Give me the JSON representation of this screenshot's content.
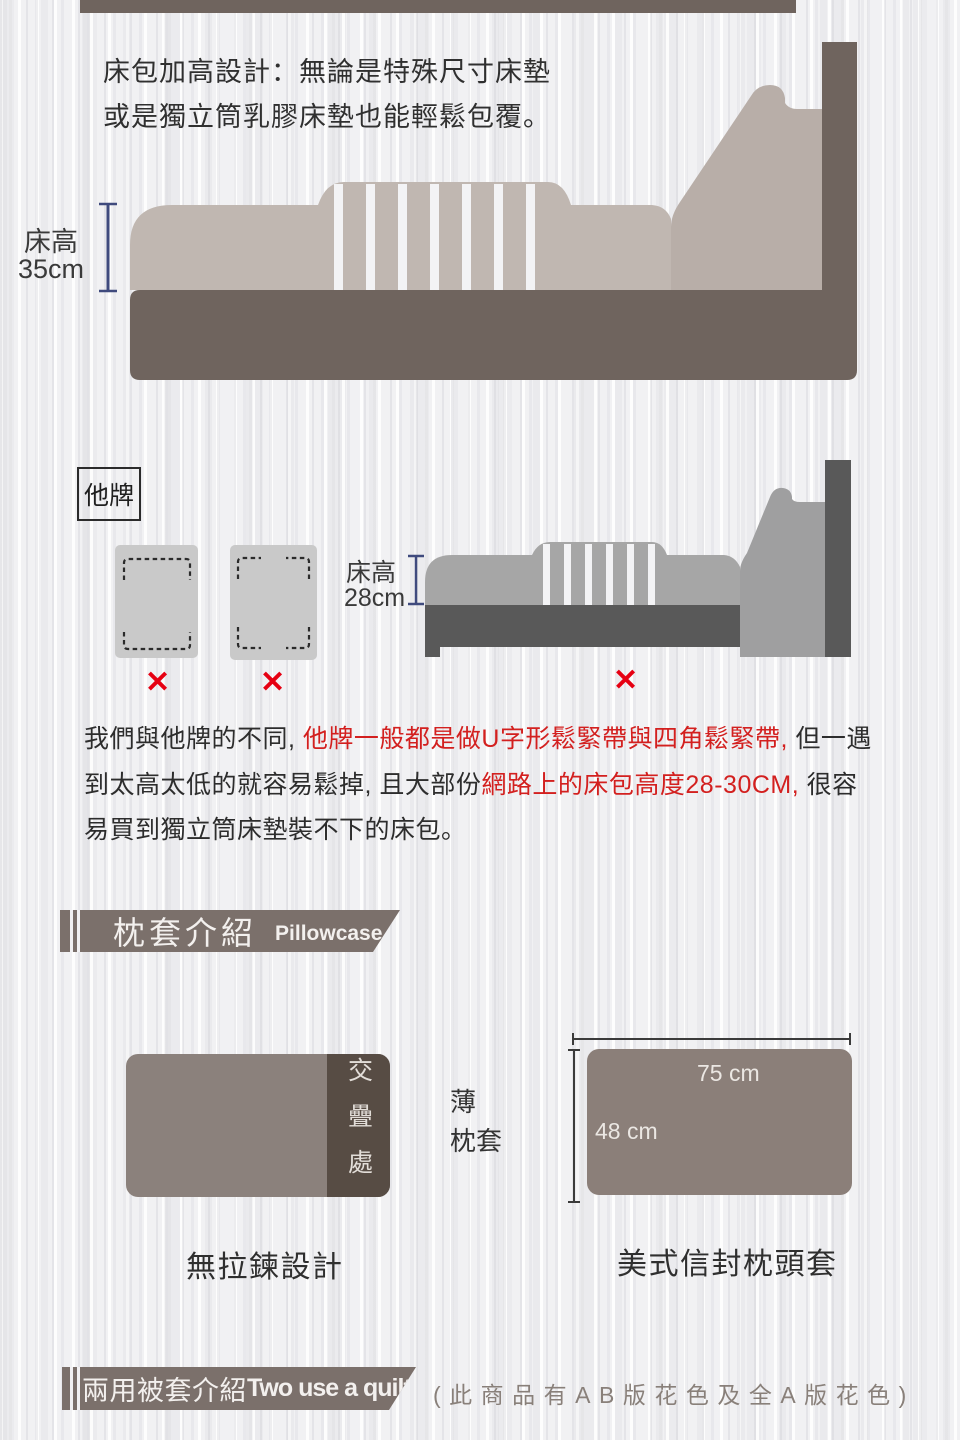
{
  "intro": {
    "text": "床包加高設計：無論是特殊尺寸床墊或是獨立筒乳膠床墊也能輕鬆包覆。"
  },
  "bed_ours": {
    "height_label": "床高",
    "height_value": "35cm"
  },
  "bed_other": {
    "badge": "他牌",
    "height_label": "床高",
    "height_value": "28cm",
    "x_mark": "✕"
  },
  "comparison": {
    "p1": "我們與他牌的不同, ",
    "p2_red": "他牌一般都是做U字形鬆緊帶與四角鬆緊帶,",
    "p3": " 但一遇到太高太低的就容易鬆掉, 且大部份",
    "p4_red": "網路上的床包高度28-30CM,",
    "p5": " 很容易買到獨立筒床墊裝不下的床包。"
  },
  "pillowcase": {
    "title_zh": "枕套介紹",
    "title_en": "Pillowcase",
    "overlap": "交疊處",
    "thin_line1": "薄",
    "thin_line2": "枕套",
    "no_zipper": "無拉鍊設計",
    "width": "75 cm",
    "height": "48 cm",
    "envelope": "美式信封枕頭套"
  },
  "quilt": {
    "title_zh": "兩用被套介紹",
    "title_en": "Two use a quilt",
    "note": "(此商品有AB版花色及全A版花色)"
  },
  "colors": {
    "dark_brown": "#6F645E",
    "mattress_beige": "#C0B7B1",
    "gray_mattress": "#A6A6A6",
    "gray_dark": "#595959",
    "red_accent": "#E60012",
    "red_text": "#D3201F",
    "measure_blue": "#3F4A7D",
    "banner_brown": "#7B706B",
    "overlap_dark": "#574C44",
    "pillow_body": "#8B7F79"
  }
}
